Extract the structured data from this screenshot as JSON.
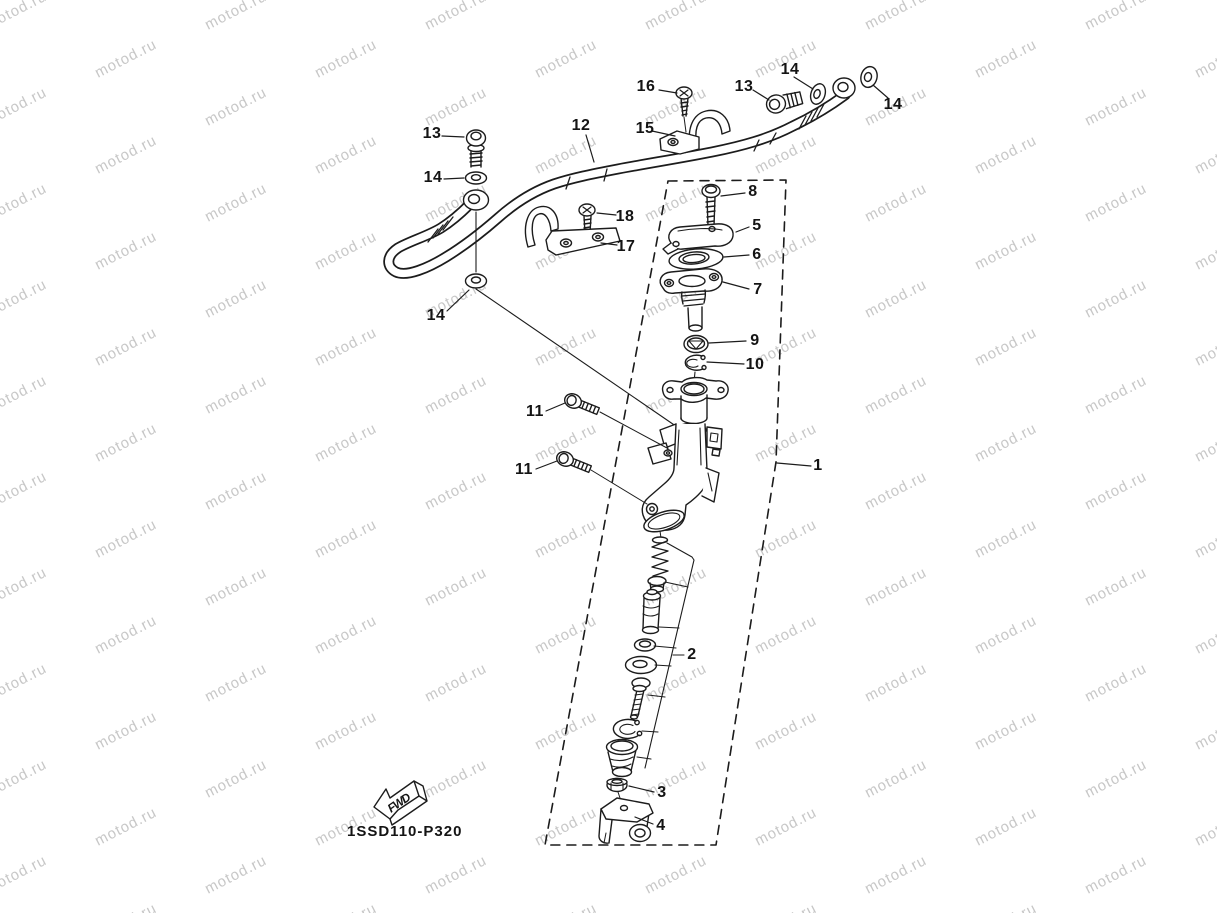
{
  "watermark": {
    "text": "motod.ru",
    "color": "#c7c7c7"
  },
  "colors": {
    "line": "#1c1c1c",
    "background": "#ffffff"
  },
  "diagram": {
    "part_code": "1SSD110-P320",
    "fwd_label": "FWD"
  },
  "callouts": {
    "1": "1",
    "2": "2",
    "3": "3",
    "4": "4",
    "5": "5",
    "6": "6",
    "7": "7",
    "8": "8",
    "9": "9",
    "10": "10",
    "11": "11",
    "12": "12",
    "13": "13",
    "14": "14",
    "15": "15",
    "16": "16",
    "17": "17",
    "18": "18"
  }
}
